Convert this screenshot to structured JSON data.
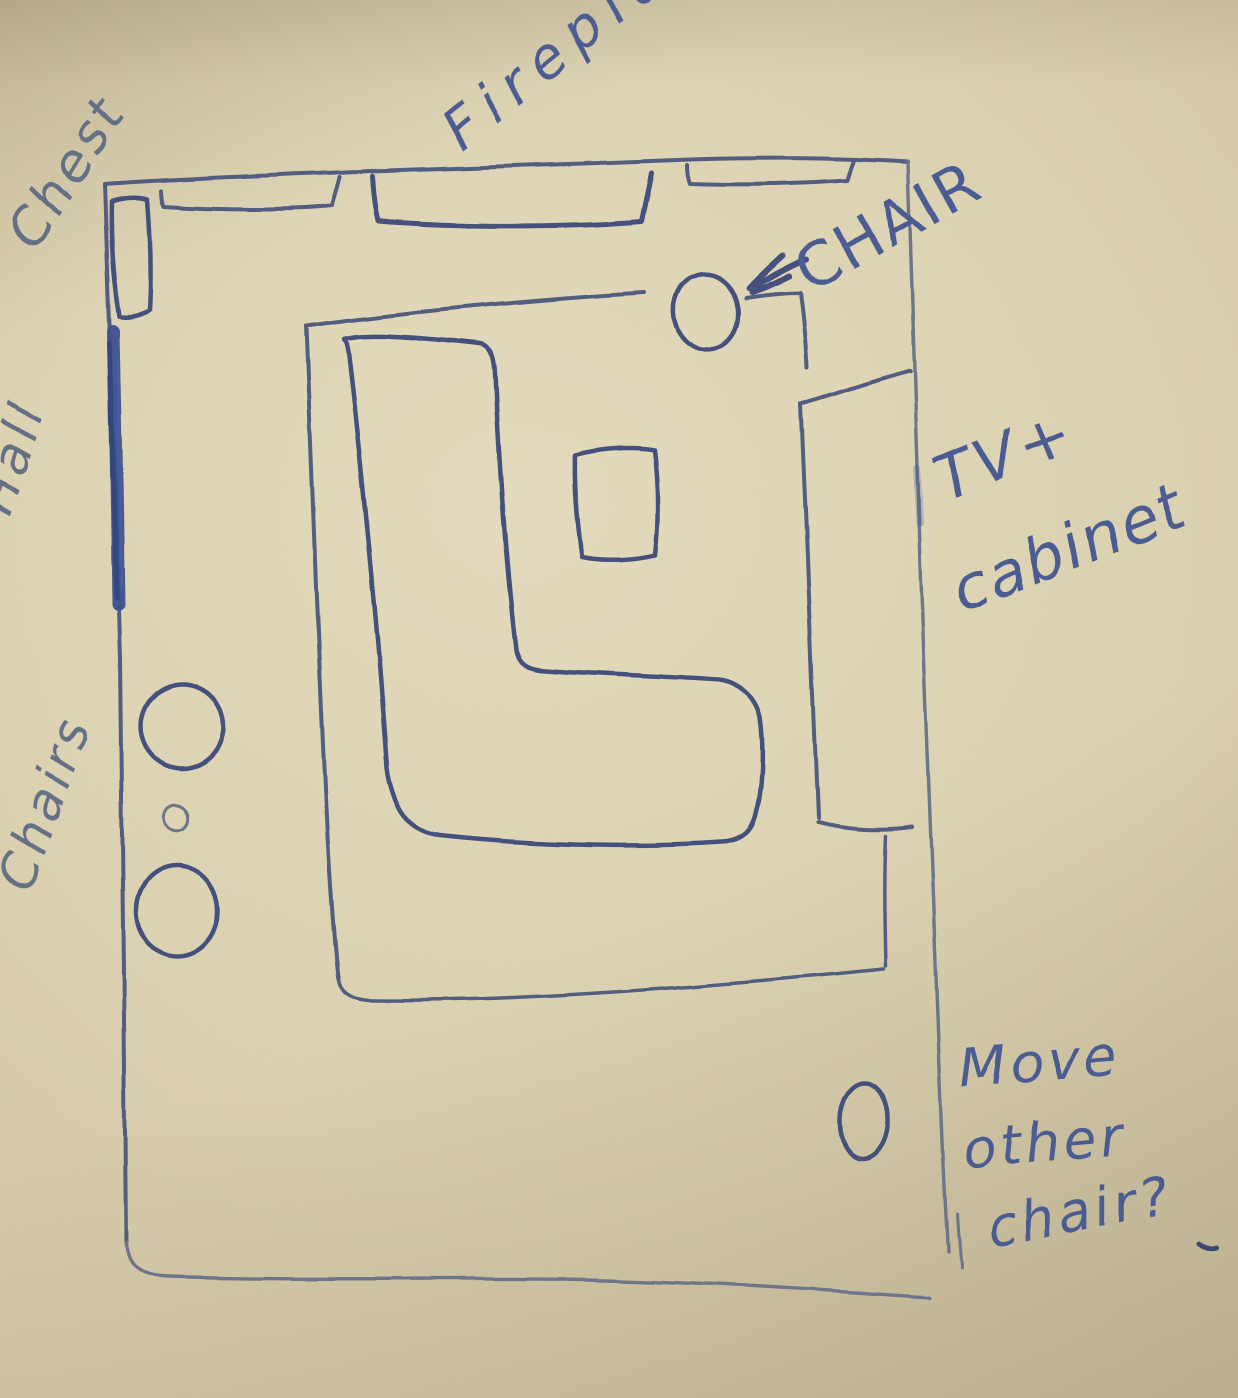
{
  "labels": {
    "chest": "Chest",
    "fireplace": "Fireplace",
    "chair_callout": "CHAIR",
    "tv_line1": "TV+",
    "tv_line2": "cabinet",
    "hall": "Hall",
    "chairs": "Chairs",
    "note_line1": "Move",
    "note_line2": "other",
    "note_line3": "chair?"
  },
  "colors": {
    "paper": "#d2c7a5",
    "paper_light": "#d9cfae",
    "paper_shadow": "#bdb190",
    "ink": "#525d7f",
    "ink_dark": "#45517b",
    "ink_light": "#6d7488",
    "ink_blue": "#3c5190",
    "text_blue": "#4c5c93",
    "text_gray": "#667085"
  },
  "items": [
    "room-outline",
    "hall-opening-mark",
    "chest-box",
    "wall-fixture-left-box",
    "fireplace-box",
    "wall-fixture-right-box",
    "armchair-circle",
    "arrow-to-chair",
    "rug-outline",
    "sectional-sofa",
    "coffee-table",
    "tv-cabinet-box",
    "side-chair-1",
    "small-stool",
    "side-chair-2",
    "corner-chair-circle"
  ]
}
